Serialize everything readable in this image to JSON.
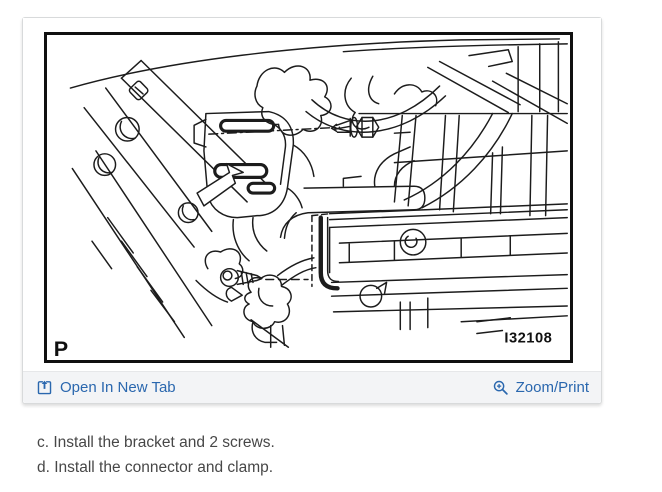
{
  "figure": {
    "corner_label": "P",
    "figure_id": "I32108"
  },
  "toolbar": {
    "open_in_new_tab": {
      "label": "Open In New Tab",
      "icon": "open-in-new-tab-icon"
    },
    "zoom_print": {
      "label": "Zoom/Print",
      "icon": "zoom-plus-icon"
    }
  },
  "instructions": [
    "c. Install the bracket and 2 screws.",
    "d. Install the connector and clamp."
  ],
  "colors": {
    "link_blue": "#2a67ae",
    "toolbar_background": "#f3f4f6",
    "card_border": "#d8dadb",
    "figure_frame": "#101010",
    "body_text": "#474747",
    "line_art": "#1c1c1c"
  }
}
